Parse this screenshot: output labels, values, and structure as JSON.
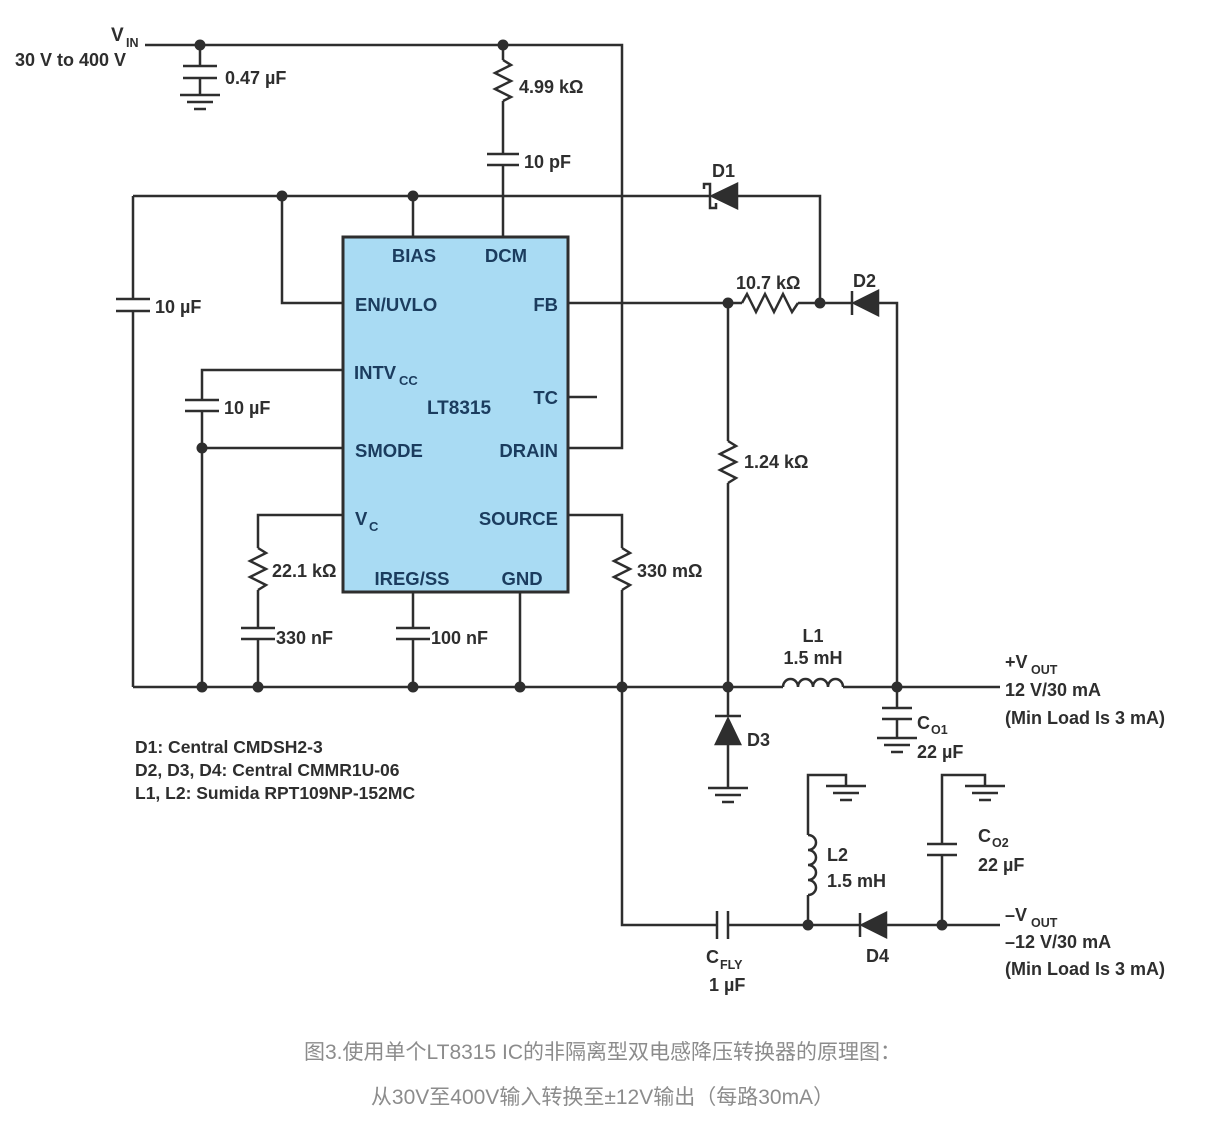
{
  "colors": {
    "wire": "#2e2e2e",
    "ic_fill": "#a9dbf3",
    "ic_text": "#1b3c5e",
    "label": "#2e2e2e",
    "caption": "#8c8c8c",
    "background": "#ffffff"
  },
  "input": {
    "vin_base": "V",
    "vin_sub": "IN",
    "vin_range": "30 V to 400 V"
  },
  "ic": {
    "part": "LT8315",
    "pin_bias": "BIAS",
    "pin_dcm": "DCM",
    "pin_en_uvlo": "EN/UVLO",
    "pin_fb": "FB",
    "pin_intvcc_base": "INTV",
    "pin_intvcc_sub": "CC",
    "pin_tc": "TC",
    "pin_smode": "SMODE",
    "pin_drain": "DRAIN",
    "pin_vc_base": "V",
    "pin_vc_sub": "C",
    "pin_source": "SOURCE",
    "pin_iregss": "IREG/SS",
    "pin_gnd": "GND"
  },
  "components": {
    "c_in": "0.47 µF",
    "r_dcm": "4.99 kΩ",
    "c_dcm": "10 pF",
    "d1": "D1",
    "c_bias": "10 µF",
    "c_intvcc": "10 µF",
    "r_fb1": "10.7 kΩ",
    "d2": "D2",
    "r_fb2": "1.24 kΩ",
    "r_vc": "22.1 kΩ",
    "c_vc": "330 nF",
    "c_ss": "100 nF",
    "r_sense": "330 mΩ",
    "d3": "D3",
    "l1_ref": "L1",
    "l1_value": "1.5 mH",
    "c_o1_base": "C",
    "c_o1_sub": "O1",
    "c_o1_value": "22 µF",
    "l2_ref": "L2",
    "l2_value": "1.5 mH",
    "c_o2_base": "C",
    "c_o2_sub": "O2",
    "c_o2_value": "22 µF",
    "c_fly_base": "C",
    "c_fly_sub": "FLY",
    "c_fly_value": "1 µF",
    "d4": "D4"
  },
  "outputs": {
    "pos_base": "+V",
    "pos_sub": "OUT",
    "pos_rating": "12 V/30 mA",
    "pos_note": "(Min Load Is 3 mA)",
    "neg_base": "–V",
    "neg_sub": "OUT",
    "neg_rating": "–12 V/30 mA",
    "neg_note": "(Min Load Is 3 mA)"
  },
  "notes": [
    "D1: Central CMDSH2-3",
    "D2, D3, D4: Central CMMR1U-06",
    "L1, L2: Sumida RPT109NP-152MC"
  ],
  "caption": {
    "line1": "图3.使用单个LT8315 IC的非隔离型双电感降压转换器的原理图：",
    "line2": "从30V至400V输入转换至±12V输出（每路30mA）"
  }
}
